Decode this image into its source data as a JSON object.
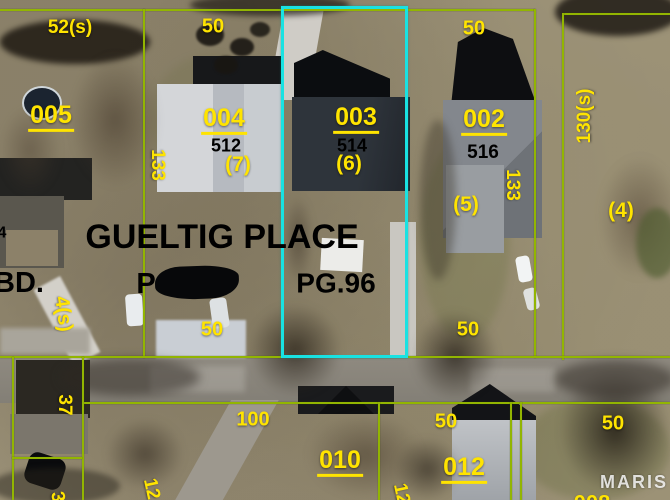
{
  "map_type": "parcel-boundary overlay on aerial photo",
  "watermark": "MARIS",
  "colors": {
    "label_yellow": "#ffe400",
    "boundary_green": "#92b501",
    "highlight_cyan": "#19e2e2",
    "text_black": "#000000"
  },
  "subdivision": {
    "name": "GUELTIG PLACE",
    "plat_fragment_left": "P",
    "plat_page": "PG.96",
    "edge_fragment": "BD."
  },
  "parcels": [
    {
      "lot": "005",
      "rear_dim": "52(s)"
    },
    {
      "lot": "004",
      "address": "512",
      "alt_lot": "(7)",
      "rear_dim": "50",
      "front_dim": "50",
      "side_dim": "133"
    },
    {
      "lot": "003",
      "address": "514",
      "alt_lot": "(6)",
      "highlighted": true
    },
    {
      "lot": "002",
      "address": "516",
      "alt_lot": "(5)",
      "rear_dim": "50",
      "front_dim": "50",
      "side_dim": "133"
    },
    {
      "lot": "(4)",
      "side_dim": "130(s)"
    },
    {
      "lot": "010",
      "front_dim": "100"
    },
    {
      "lot": "012",
      "front_dim": "50"
    }
  ],
  "labels": [
    {
      "name": "dim-52s-lot005",
      "text": "52(s)",
      "x": 70,
      "y": 28,
      "s": 19,
      "color": "yellow"
    },
    {
      "name": "dim-50-rear-lot004",
      "text": "50",
      "x": 213,
      "y": 27,
      "s": 20,
      "color": "yellow"
    },
    {
      "name": "dim-50-rear-lot002",
      "text": "50",
      "x": 474,
      "y": 29,
      "s": 20,
      "color": "yellow"
    },
    {
      "name": "lot-number-005",
      "text": "005",
      "x": 51,
      "y": 117,
      "s": 25,
      "color": "yellow",
      "u": true
    },
    {
      "name": "lot-number-004",
      "text": "004",
      "x": 224,
      "y": 120,
      "s": 25,
      "color": "yellow",
      "u": true
    },
    {
      "name": "address-512",
      "text": "512",
      "x": 226,
      "y": 146,
      "s": 18,
      "color": "black"
    },
    {
      "name": "alt-lot-7",
      "text": "(7)",
      "x": 238,
      "y": 165,
      "s": 21,
      "color": "yellow"
    },
    {
      "name": "lot-number-003",
      "text": "003",
      "x": 356,
      "y": 119,
      "s": 25,
      "color": "yellow",
      "u": true
    },
    {
      "name": "address-514",
      "text": "514",
      "x": 352,
      "y": 146,
      "s": 18,
      "color": "black"
    },
    {
      "name": "alt-lot-6",
      "text": "(6)",
      "x": 349,
      "y": 164,
      "s": 21,
      "color": "yellow"
    },
    {
      "name": "lot-number-002",
      "text": "002",
      "x": 484,
      "y": 121,
      "s": 25,
      "color": "yellow",
      "u": true
    },
    {
      "name": "address-516",
      "text": "516",
      "x": 483,
      "y": 153,
      "s": 19,
      "color": "black"
    },
    {
      "name": "alt-lot-5",
      "text": "(5)",
      "x": 466,
      "y": 205,
      "s": 21,
      "color": "yellow"
    },
    {
      "name": "dim-133-west",
      "text": "133",
      "x": 157,
      "y": 165,
      "s": 19,
      "color": "yellow",
      "r": 90
    },
    {
      "name": "dim-133-east",
      "text": "133",
      "x": 512,
      "y": 185,
      "s": 19,
      "color": "yellow",
      "r": 90
    },
    {
      "name": "dim-130s",
      "text": "130(s)",
      "x": 585,
      "y": 116,
      "s": 19,
      "color": "yellow",
      "r": -90
    },
    {
      "name": "alt-lot-4",
      "text": "(4)",
      "x": 621,
      "y": 211,
      "s": 21,
      "color": "yellow"
    },
    {
      "name": "subdivision-name",
      "text": "GUELTIG PLACE",
      "x": 222,
      "y": 238,
      "s": 34,
      "color": "black"
    },
    {
      "name": "label-bd-fragment",
      "text": "BD.",
      "x": 19,
      "y": 283,
      "s": 29,
      "color": "black"
    },
    {
      "name": "label-plat-fragment",
      "text": "P",
      "x": 146,
      "y": 284,
      "s": 29,
      "color": "black"
    },
    {
      "name": "label-plat-page",
      "text": "PG.96",
      "x": 336,
      "y": 283,
      "s": 28,
      "color": "black"
    },
    {
      "name": "address-partial-4",
      "text": "4",
      "x": 2,
      "y": 234,
      "s": 16,
      "color": "black"
    },
    {
      "name": "dim-4s",
      "text": "4(s)",
      "x": 63,
      "y": 314,
      "s": 20,
      "color": "yellow",
      "r": 82
    },
    {
      "name": "dim-50-front-lot004",
      "text": "50",
      "x": 212,
      "y": 330,
      "s": 20,
      "color": "yellow"
    },
    {
      "name": "dim-50-front-lot002",
      "text": "50",
      "x": 468,
      "y": 330,
      "s": 20,
      "color": "yellow"
    },
    {
      "name": "dim-37",
      "text": "37",
      "x": 64,
      "y": 405,
      "s": 19,
      "color": "yellow",
      "r": 90
    },
    {
      "name": "dim-100",
      "text": "100",
      "x": 253,
      "y": 420,
      "s": 20,
      "color": "yellow"
    },
    {
      "name": "lot-number-010",
      "text": "010",
      "x": 340,
      "y": 462,
      "s": 25,
      "color": "yellow",
      "u": true
    },
    {
      "name": "dim-50-lot012",
      "text": "50",
      "x": 446,
      "y": 422,
      "s": 20,
      "color": "yellow"
    },
    {
      "name": "lot-number-012",
      "text": "012",
      "x": 464,
      "y": 469,
      "s": 25,
      "color": "yellow",
      "u": true
    },
    {
      "name": "dim-50-southeast",
      "text": "50",
      "x": 613,
      "y": 424,
      "s": 20,
      "color": "yellow"
    },
    {
      "name": "dim-12-west",
      "text": "12",
      "x": 151,
      "y": 489,
      "s": 19,
      "color": "yellow",
      "r": 78
    },
    {
      "name": "dim-12-center",
      "text": "12",
      "x": 401,
      "y": 494,
      "s": 19,
      "color": "yellow",
      "r": 78
    },
    {
      "name": "dim-3-partial",
      "text": "3",
      "x": 57,
      "y": 497,
      "s": 19,
      "color": "yellow",
      "r": 80
    },
    {
      "name": "lot-number-partial",
      "text": "008",
      "x": 592,
      "y": 503,
      "s": 22,
      "color": "yellow"
    }
  ]
}
